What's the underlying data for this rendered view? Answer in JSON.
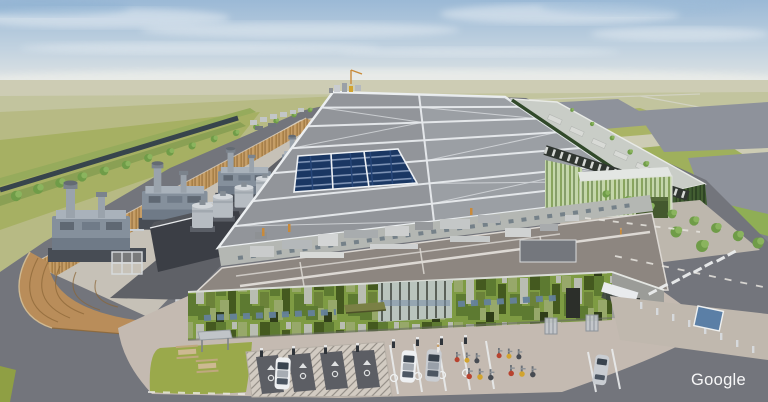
{
  "meta": {
    "domain": "Natural-Image",
    "description": "Aerial 3D architectural rendering of a hyperscale data center campus set in flat green farmland under a hazy blue sky",
    "rendering_style": "computer generated visualization"
  },
  "watermark": {
    "text": "Google",
    "color": "#ffffff"
  },
  "colors": {
    "sky_top": "#9bb9d6",
    "sky_mid": "#c3d3e0",
    "sky_horizon": "#e7e8e4",
    "cloud": "#f2f5f7",
    "field_far": "#cdccb4",
    "field_band": "#c2c49e",
    "field_mid": "#b7ba84",
    "field_near": "#a6b063",
    "pond": "#8e929b",
    "canal": "#37444c",
    "tree": "#6f9c48",
    "tree_light": "#8ab45e",
    "berm_green": "#8fae55",
    "asphalt": "#73757c",
    "dark_road": "#5f6167",
    "pad": "#c6c1b7",
    "wood": "#c59d66",
    "wood_dark": "#a1793f",
    "generator": "#85909c",
    "dark_building": "#3b3e45",
    "tank": "#b6bcc2",
    "roof_gray": "#92959a",
    "roof_line": "#eceff1",
    "solar_dark": "#1a3763",
    "solar_gap": "#7e93b5",
    "green_wall": "#2e4424",
    "green_glass": "#c4d6aa",
    "facade_green": "#7e9b43",
    "facade_dark": "#44591f",
    "facade_gray": "#b9bdb2",
    "mech_roof": "#8d8680",
    "wall_light": "#b4b7b3",
    "plaza": "#c4bab1",
    "lawn": "#9aa94b",
    "hatch_bg": "#d2cbc2",
    "stall": "#5c5e64",
    "car_white": "#eef0f2",
    "car_silver": "#c9cdd2",
    "bike_red": "#b8432f",
    "bike_yellow": "#d2a42f",
    "sign_blue": "#5b7fa6",
    "awning": "#7a8045"
  },
  "scene": {
    "sky": {
      "label": "hazy blue sky with thin stratus clouds"
    },
    "landscape": {
      "fields": "flat tan-green farmland stretching to the horizon",
      "ponds": "grey retention ponds east of the campus",
      "canal": "drainage canal with hedgerow along the west boundary",
      "access_road": "tree-lined access road on the east side"
    },
    "campus": {
      "type": "hyperscale data center campus",
      "west_screen": "timber slat screening fence and curved timber wall",
      "generators": "row of backup generator units with exhaust stacks",
      "cooling": "row of cylindrical cooling units along the service road",
      "main_hall": "long data hall roof with white structural frames and diagonal markings",
      "solar": "rooftop solar photovoltaic array",
      "east_hall": "green-clad data hall with rooftop plant",
      "entrance_pavilion": "green glass entrance pavilion",
      "plant_roof": "central plant roof with HVAC ducts and white walkways",
      "office": "green mosaic-clad office block with olive entrance canopy"
    },
    "foreground": {
      "plaza": "light concrete plaza",
      "lawn": "lawn with picnic tables and shelter",
      "ev_parking": "hatched EV charging bays with white cars and charge points",
      "bikes": "bicycle racks with parked bikes",
      "road": "dark asphalt perimeter road with dashed white markings"
    }
  }
}
